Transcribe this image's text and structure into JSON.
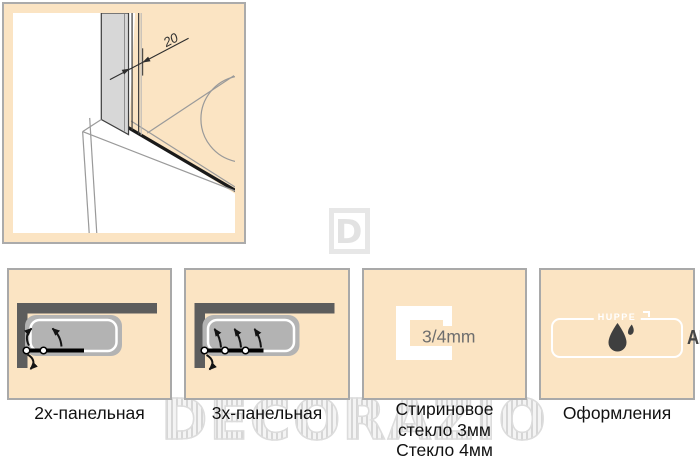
{
  "colors": {
    "peach": "#FBE4C3",
    "panel_border": "#A9A9A9",
    "frame_border": "#ABABAB",
    "wall_dark": "#5D5D5D",
    "tub_gray": "#B3B3B3",
    "line_gray": "#9A9A9A",
    "drawing_gray": "#D7D7D7",
    "label_text": "#111111",
    "logo_text": "#454545",
    "dim_text": "#2E2E2E",
    "glass_text": "#6E6E6E",
    "watermark_gray": "#DCDCDC"
  },
  "tech_drawing": {
    "dimension_label": "20"
  },
  "watermark": {
    "text": "DECORAZIO",
    "logo_letter": "D"
  },
  "panels": [
    {
      "type": "bathtub-screen-2-panel",
      "label": "2х-панельная"
    },
    {
      "type": "bathtub-screen-3-panel",
      "label": "3х-панельная"
    },
    {
      "type": "glass-profile",
      "glass_text": "3/4mm",
      "label_lines": [
        "Стириновое",
        "стекло 3мм",
        "Стекло 4мм"
      ]
    },
    {
      "type": "coating",
      "brand": "HUPPE",
      "logo_text": "ANTI-PLAQUE",
      "label": "Оформления"
    }
  ]
}
